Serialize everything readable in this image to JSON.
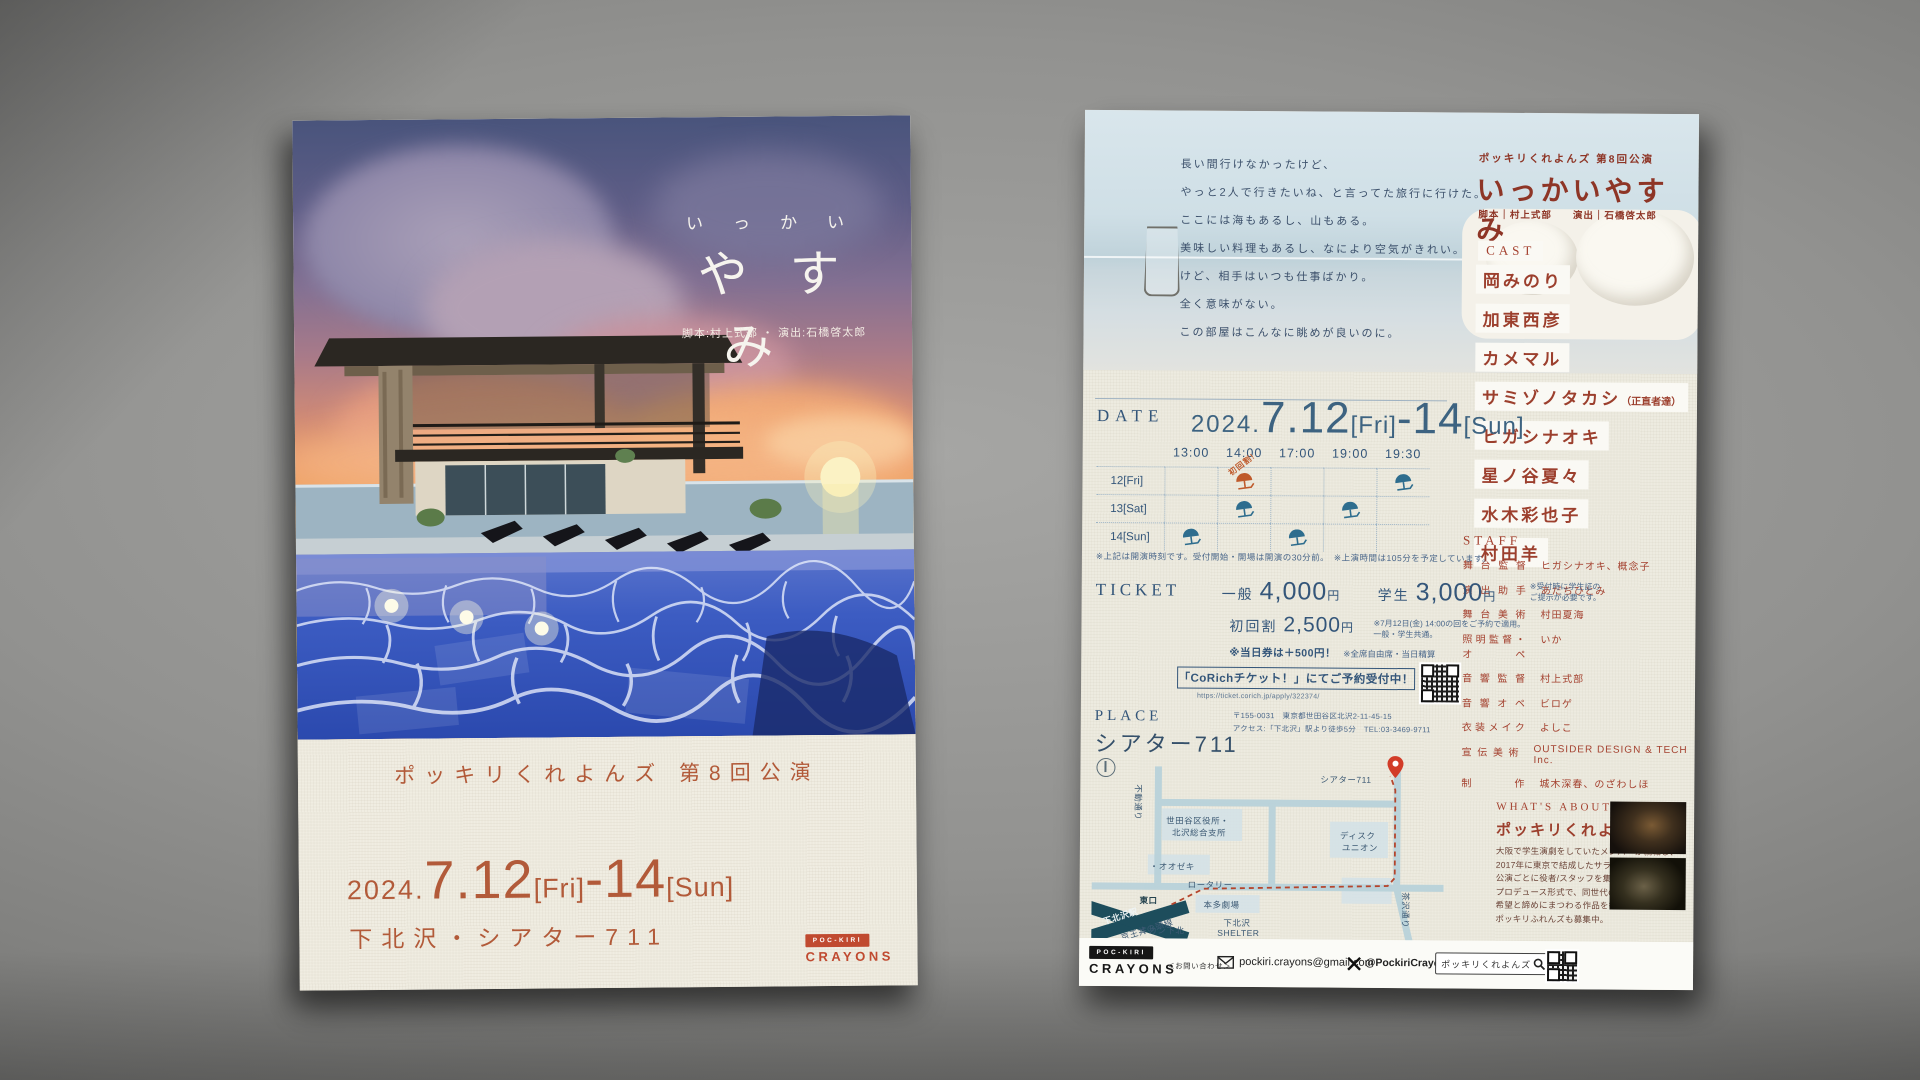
{
  "front": {
    "title_small": "いっかい",
    "title_big": "やすみ",
    "credit": "脚本:村上式部 ・ 演出:石橋啓太郎",
    "company_line": "ポッキリくれよんズ 第8回公演",
    "date": {
      "year": "2024.",
      "day1": "7.12",
      "w1": "[Fri]",
      "dash": "-",
      "day2": "14",
      "w2": "[Sun]"
    },
    "venue": "下北沢・シアター711",
    "logo": {
      "box": "POC-KIRI",
      "word": "CRAYONS"
    }
  },
  "back": {
    "header": {
      "company_line": "ポッキリくれよんズ 第8回公演",
      "title": "いっかいやすみ",
      "credit": "脚本｜村上式部　　演出｜石橋啓太郎"
    },
    "poem": [
      "長い間行けなかったけど、",
      "やっと2人で行きたいね、と言ってた旅行に行けた。",
      "ここには海もあるし、山もある。",
      "美味しい料理もあるし、なにより空気がきれい。",
      "けど、相手はいつも仕事ばかり。",
      "全く意味がない。",
      "この部屋はこんなに眺めが良いのに。"
    ],
    "cast": {
      "label": "CAST",
      "members": [
        {
          "name": "岡みのり",
          "note": ""
        },
        {
          "name": "加東西彦",
          "note": ""
        },
        {
          "name": "カメマル",
          "note": ""
        },
        {
          "name": "サミゾノタカシ",
          "note": "（正直者達）"
        },
        {
          "name": "ヒガシナオキ",
          "note": ""
        },
        {
          "name": "星ノ谷夏々",
          "note": ""
        },
        {
          "name": "水木彩也子",
          "note": ""
        },
        {
          "name": "村田羊",
          "note": ""
        }
      ]
    },
    "staff": {
      "label": "STAFF",
      "rows": [
        {
          "role": "舞台監督",
          "name": "ヒガシナオキ、概念子"
        },
        {
          "role": "演出助手",
          "name": "あだちひとみ"
        },
        {
          "role": "舞台美術",
          "name": "村田夏海"
        },
        {
          "role": "照明監督・オペ",
          "name": "いか"
        },
        {
          "role": "音響監督",
          "name": "村上式部"
        },
        {
          "role": "音響オペ",
          "name": "ビロゲ"
        },
        {
          "role": "衣装メイク",
          "name": "よしこ"
        },
        {
          "role": "宣伝美術",
          "name": "OUTSIDER DESIGN & TECH Inc."
        },
        {
          "role": "制作",
          "name": "城木深春、のざわしほ"
        }
      ]
    },
    "date_section": {
      "label": "DATE",
      "date": {
        "year": "2024.",
        "day1": "7.12",
        "w1": "[Fri]",
        "dash": "-",
        "day2": "14",
        "w2": "[Sun]"
      },
      "schedule": {
        "times": [
          "13:00",
          "14:00",
          "17:00",
          "19:00",
          "19:30"
        ],
        "rows": [
          {
            "day": "12[Fri]",
            "marks": [
              "",
              "first",
              "",
              "",
              "blue"
            ]
          },
          {
            "day": "13[Sat]",
            "marks": [
              "",
              "blue",
              "",
              "blue",
              ""
            ]
          },
          {
            "day": "14[Sun]",
            "marks": [
              "blue",
              "",
              "blue",
              "",
              ""
            ]
          }
        ],
        "first_badge": "初回割!",
        "note": "※上記は開演時刻です。受付開始・開場は開演の30分前。　※上演時間は105分を予定しています。"
      }
    },
    "ticket": {
      "label": "TICKET",
      "general_label": "一般",
      "general_price": "4,000",
      "yen": "円",
      "student_label": "学生",
      "student_price": "3,000",
      "student_note": [
        "※受付時に学生証の",
        "ご提示が必要です。"
      ],
      "discount_label": "初回割",
      "discount_price": "2,500",
      "discount_note": [
        "※7月12日(金) 14:00の回をご予約で適用。",
        "一般・学生共通。"
      ],
      "sameday_note": "※当日券は＋500円！",
      "seat_note": "※全席自由席・当日精算",
      "corich": "「CoRichチケット！」にてご予約受付中！",
      "corich_url": "https://ticket.corich.jp/apply/322374/"
    },
    "place": {
      "label": "PLACE",
      "venue": "シアター711",
      "addr1": "〒155-0031　東京都世田谷区北沢2-11-45-15",
      "addr2": "アクセス:「下北沢」駅より徒歩5分　TEL:03-3469-9711"
    },
    "map": {
      "labels": [
        {
          "text": "不動通り",
          "x": 52,
          "y": 26,
          "rot": 90
        },
        {
          "text": "シアター711",
          "x": 228,
          "y": 14
        },
        {
          "text": "世田谷区役所・",
          "x": 74,
          "y": 56
        },
        {
          "text": "北沢総合支所",
          "x": 80,
          "y": 68
        },
        {
          "text": "・オオゼキ",
          "x": 58,
          "y": 102
        },
        {
          "text": "ディスク",
          "x": 248,
          "y": 70
        },
        {
          "text": "ユニオン",
          "x": 250,
          "y": 82
        },
        {
          "text": "ロータリー",
          "x": 96,
          "y": 120
        },
        {
          "text": "本多劇場",
          "x": 112,
          "y": 140
        },
        {
          "text": "ミカン下北",
          "x": 48,
          "y": 166
        },
        {
          "text": "下北沢",
          "x": 132,
          "y": 158
        },
        {
          "text": "SHELTER",
          "x": 126,
          "y": 169
        },
        {
          "text": "茶沢通り",
          "x": 320,
          "y": 132,
          "rot": 90
        },
        {
          "text": "東口",
          "x": 48,
          "y": 136,
          "cls": "dark"
        },
        {
          "text": "下北沢駅",
          "x": 10,
          "y": 158,
          "cls": "station",
          "rot": -18
        },
        {
          "text": "京王井の頭線",
          "x": 28,
          "y": 174,
          "rot": -18
        }
      ]
    },
    "about": {
      "label": "WHAT'S ABOUT",
      "name": "ポッキリくれよんズ",
      "lines": [
        "大阪で学生演劇をしていたメンバーが就職し、",
        "2017年に東京で結成したサラリーマン劇団。",
        "公演ごとに役者/スタッフを集める",
        "プロデュース形式で、同世代の夢と悩みと",
        "希望と諦めにまつわる作品を行う。",
        "ポッキリふれんズも募集中。"
      ]
    },
    "footer": {
      "logo": {
        "box": "POC-KIRI",
        "word": "CRAYONS"
      },
      "contact_label": "＜お問い合わせ＞",
      "email": "pockiri.crayons@gmail.com",
      "x_handle": "@PockiriCrayons",
      "search_text": "ポッキリくれよんズ"
    }
  },
  "colors": {
    "terracotta": "#b25a39",
    "dark_red": "#8e3526",
    "navy": "#34567a",
    "umbrella_blue": "#2e6d8e",
    "umbrella_orange": "#bf5a2b",
    "pin_red": "#d23c28"
  }
}
